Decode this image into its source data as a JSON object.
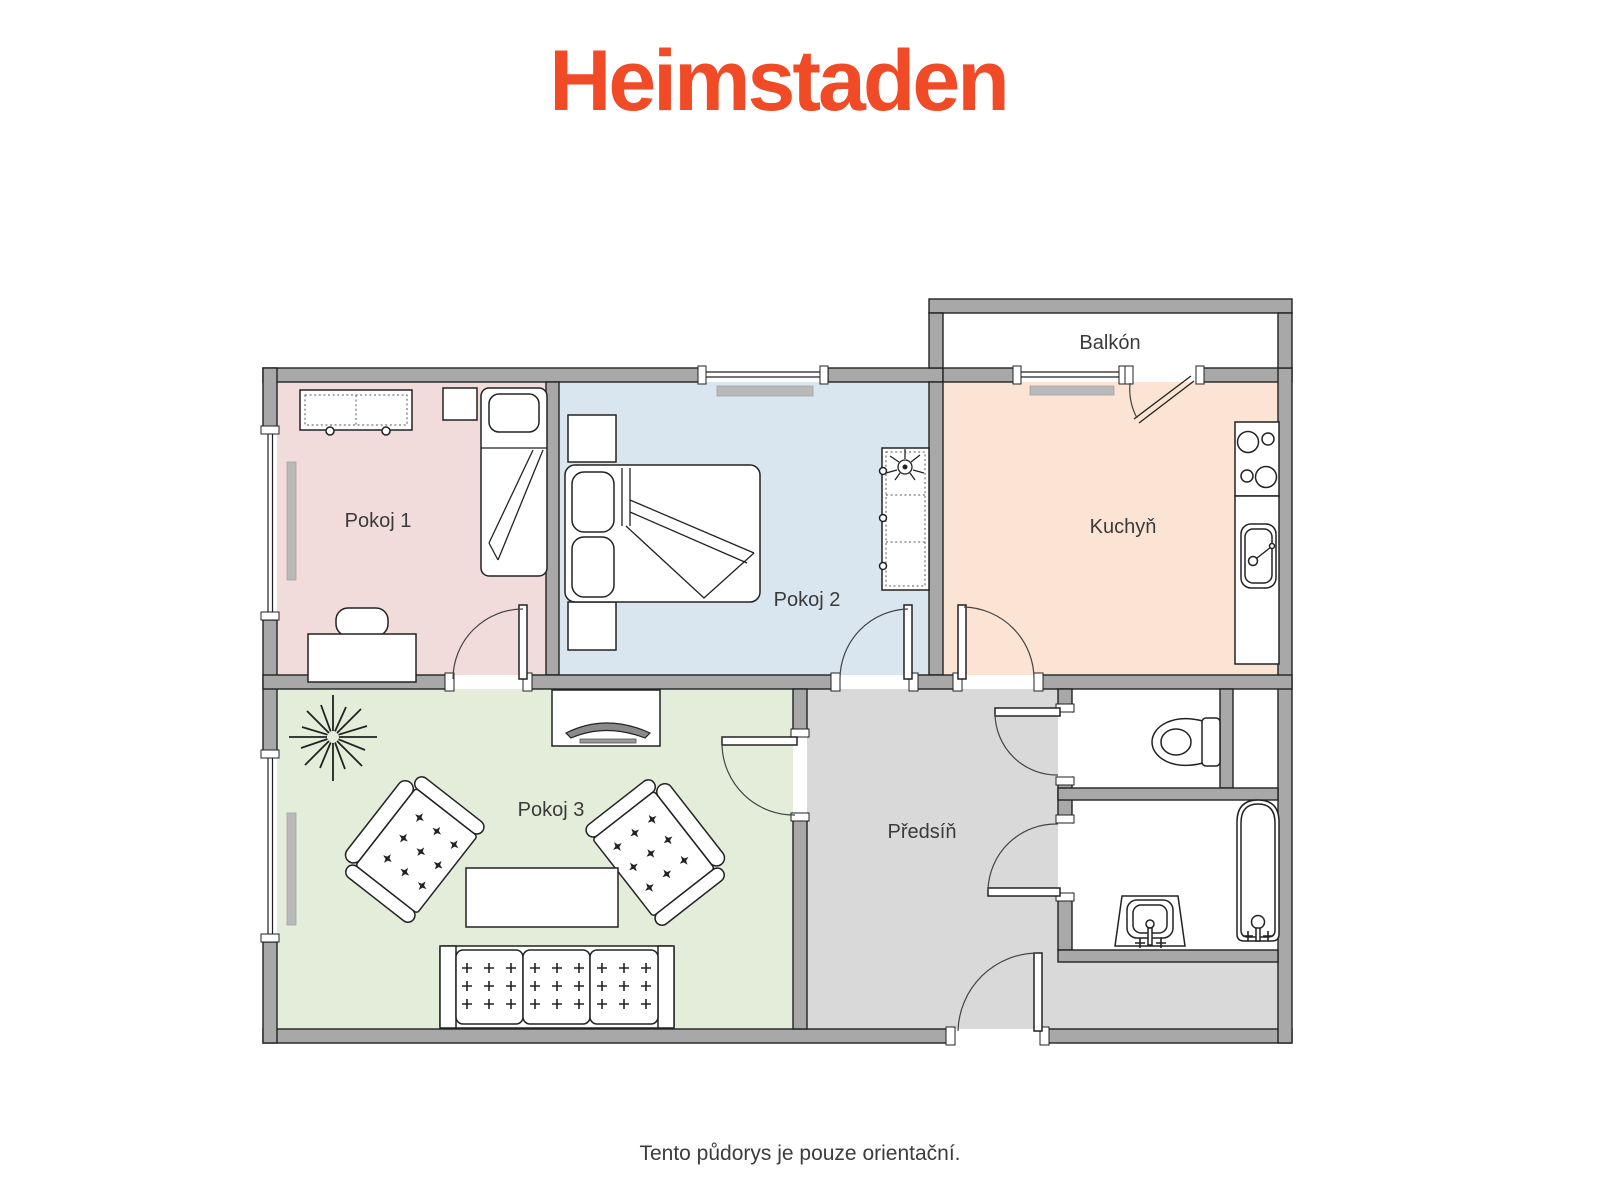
{
  "brand": {
    "logo_text": "Heimstaden",
    "logo_color": "#f14a26"
  },
  "footer": {
    "disclaimer": "Tento půdorys je pouze orientační."
  },
  "floor_plan": {
    "wall_color": "#a8a8a8",
    "outline_color": "#222222",
    "rooms": [
      {
        "id": "pokoj-1",
        "label": "Pokoj 1",
        "color": "#f2dcdb"
      },
      {
        "id": "pokoj-2",
        "label": "Pokoj 2",
        "color": "#d9e6f0"
      },
      {
        "id": "pokoj-3",
        "label": "Pokoj 3",
        "color": "#e4edda"
      },
      {
        "id": "kuchyn",
        "label": "Kuchyň",
        "color": "#fce4d4"
      },
      {
        "id": "predsin",
        "label": "Předsíň",
        "color": "#d9d9d9"
      },
      {
        "id": "balkon",
        "label": "Balkón",
        "color": "#ffffff"
      },
      {
        "id": "wc",
        "label": "",
        "color": "#ffffff"
      },
      {
        "id": "koupelna",
        "label": "",
        "color": "#ffffff"
      }
    ],
    "fixtures": [
      "dresser",
      "nightstand",
      "single-bed",
      "desk",
      "desk-chair",
      "double-bed",
      "wardrobe",
      "plant",
      "stove",
      "kitchen-counter",
      "kitchen-sink",
      "toilet",
      "washbasin",
      "bathtub",
      "tv-stand",
      "tv",
      "houseplant",
      "armchair",
      "coffee-table",
      "sofa",
      "radiator",
      "window",
      "door"
    ]
  }
}
